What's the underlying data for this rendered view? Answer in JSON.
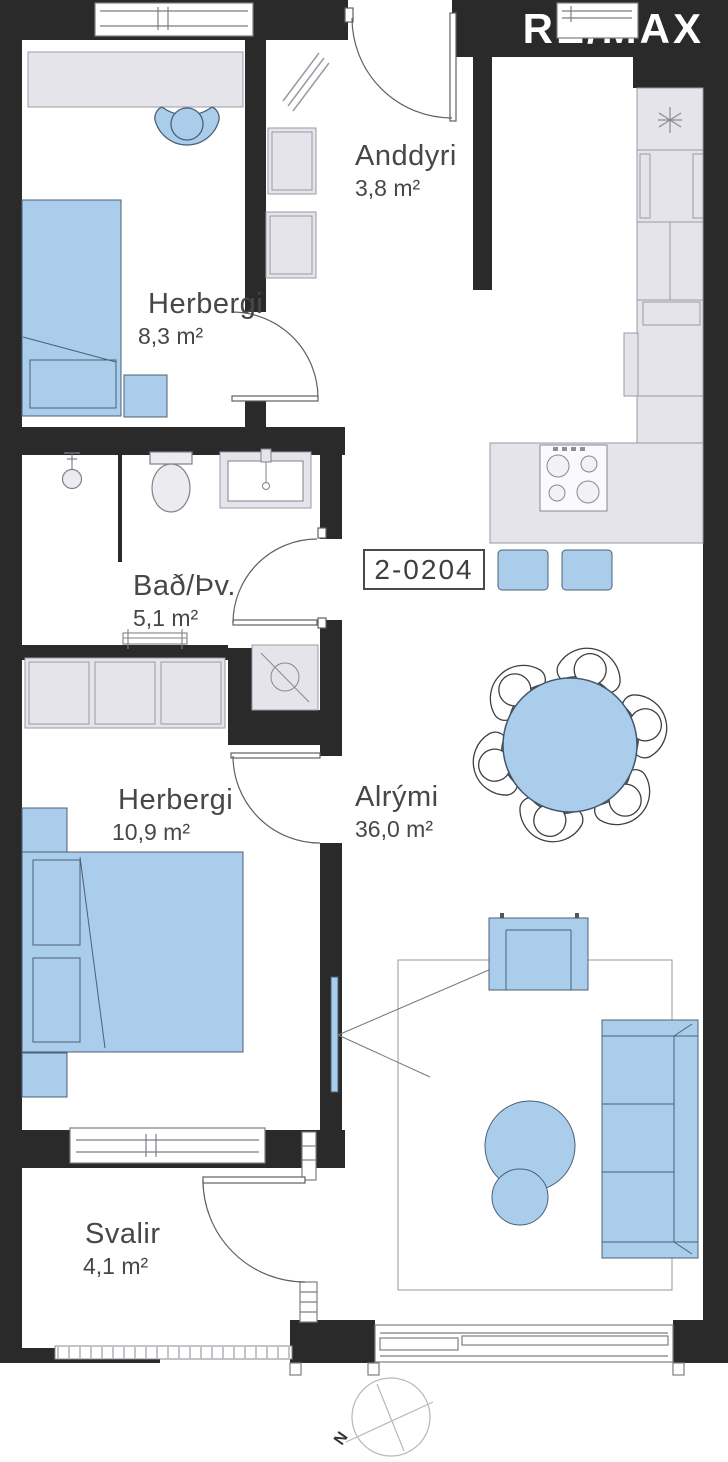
{
  "logo": {
    "text": "RE/MAX"
  },
  "unit": {
    "number": "2-0204"
  },
  "rooms": {
    "anddyri": {
      "name": "Anddyri",
      "area": "3,8 m²"
    },
    "herbergi1": {
      "name": "Herbergi",
      "area": "8,3 m²"
    },
    "bad": {
      "name": "Bað/Þv.",
      "area": "5,1 m²"
    },
    "alrymi": {
      "name": "Alrými",
      "area": "36,0 m²"
    },
    "herbergi2": {
      "name": "Herbergi",
      "area": "10,9 m²"
    },
    "svalir": {
      "name": "Svalir",
      "area": "4,1 m²"
    }
  },
  "compass": {
    "north_label": "N"
  },
  "colors": {
    "wall": "#2a2a2a",
    "furniture_blue": "#a9cdeb",
    "furniture_gray": "#e4e4ea",
    "label_text": "#474747"
  }
}
